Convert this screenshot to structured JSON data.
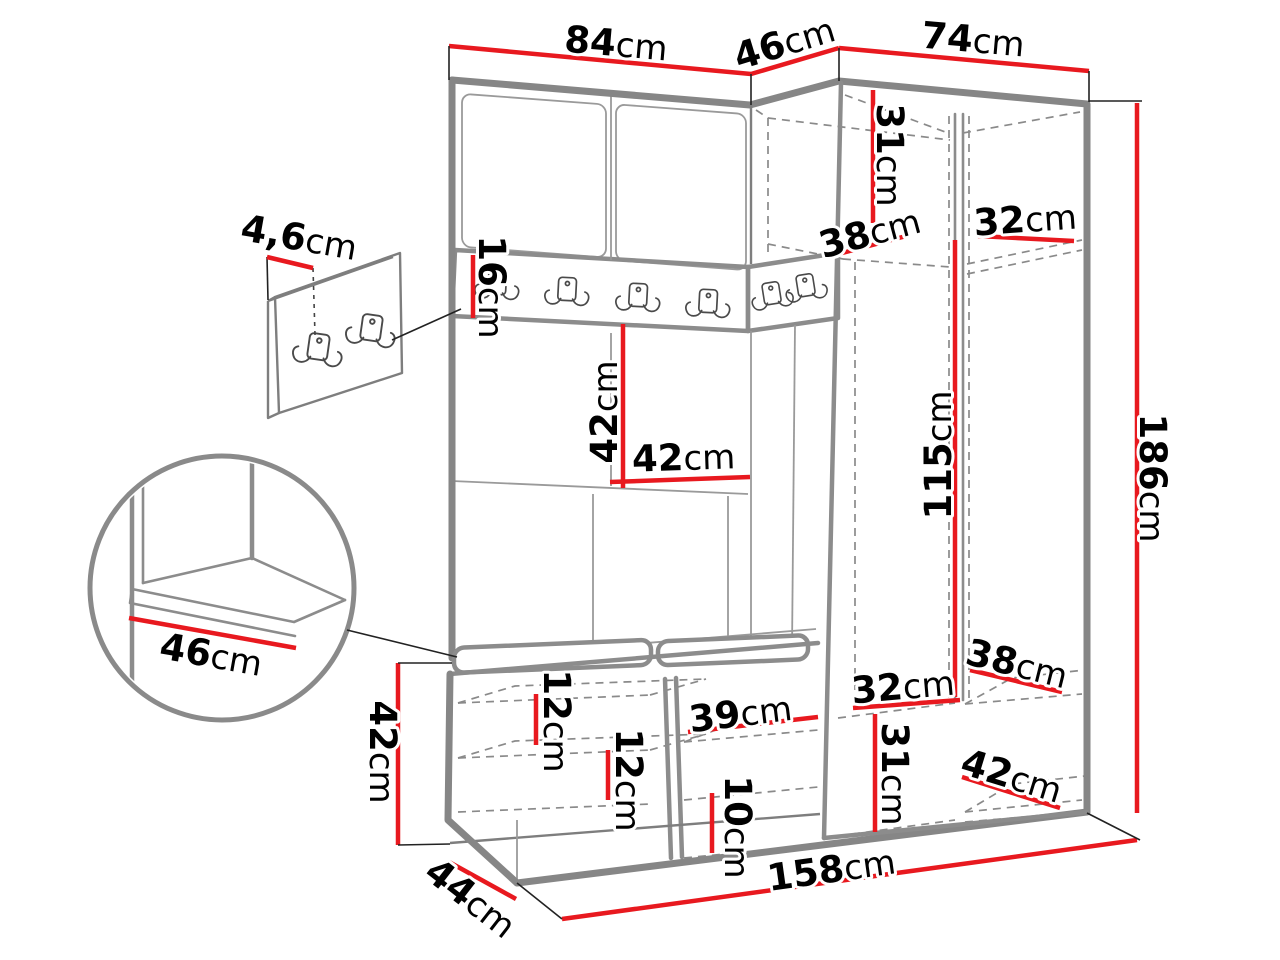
{
  "meta": {
    "title": "Hallway wardrobe set dimension diagram",
    "unit_system": "cm",
    "drawing_parts": [
      "corner wardrobe",
      "coat hook rail",
      "upper cabinets",
      "shoe bench with cushions",
      "wall hook panel detail",
      "seat corner detail"
    ]
  },
  "colors": {
    "dimension_line": "#e8191f",
    "outline": "#868686",
    "text": "#000000",
    "background": "#ffffff"
  },
  "icons": {
    "coat_hook": "double-coat-hook"
  },
  "dims": {
    "width_left_top": {
      "value": "84",
      "unit": "cm"
    },
    "width_corner_top": {
      "value": "46",
      "unit": "cm"
    },
    "width_right_top": {
      "value": "74",
      "unit": "cm"
    },
    "height_total": {
      "value": "186",
      "unit": "cm"
    },
    "height_hanging": {
      "value": "115",
      "unit": "cm"
    },
    "upper_cabinet_height": {
      "value": "31",
      "unit": "cm"
    },
    "upper_cabinet_depth": {
      "value": "38",
      "unit": "cm"
    },
    "upper_shelf_width": {
      "value": "32",
      "unit": "cm"
    },
    "hook_rail_height": {
      "value": "16",
      "unit": "cm"
    },
    "back_panel_height": {
      "value": "42",
      "unit": "cm"
    },
    "back_panel_width": {
      "value": "42",
      "unit": "cm"
    },
    "wall_panel_depth": {
      "value": "4,6",
      "unit": "cm"
    },
    "seat_depth_detail": {
      "value": "46",
      "unit": "cm"
    },
    "bench_height": {
      "value": "42",
      "unit": "cm"
    },
    "shoe_shelf_gap_top": {
      "value": "12",
      "unit": "cm"
    },
    "shoe_shelf_gap_bottom": {
      "value": "12",
      "unit": "cm"
    },
    "bench_compartment_width": {
      "value": "39",
      "unit": "cm"
    },
    "floor_gap": {
      "value": "10",
      "unit": "cm"
    },
    "lower_shelf_width": {
      "value": "32",
      "unit": "cm"
    },
    "lower_section_height": {
      "value": "31",
      "unit": "cm"
    },
    "lower_shelf_depth": {
      "value": "38",
      "unit": "cm"
    },
    "base_shelf_depth": {
      "value": "42",
      "unit": "cm"
    },
    "width_total": {
      "value": "158",
      "unit": "cm"
    },
    "bench_depth": {
      "value": "44",
      "unit": "cm"
    }
  }
}
